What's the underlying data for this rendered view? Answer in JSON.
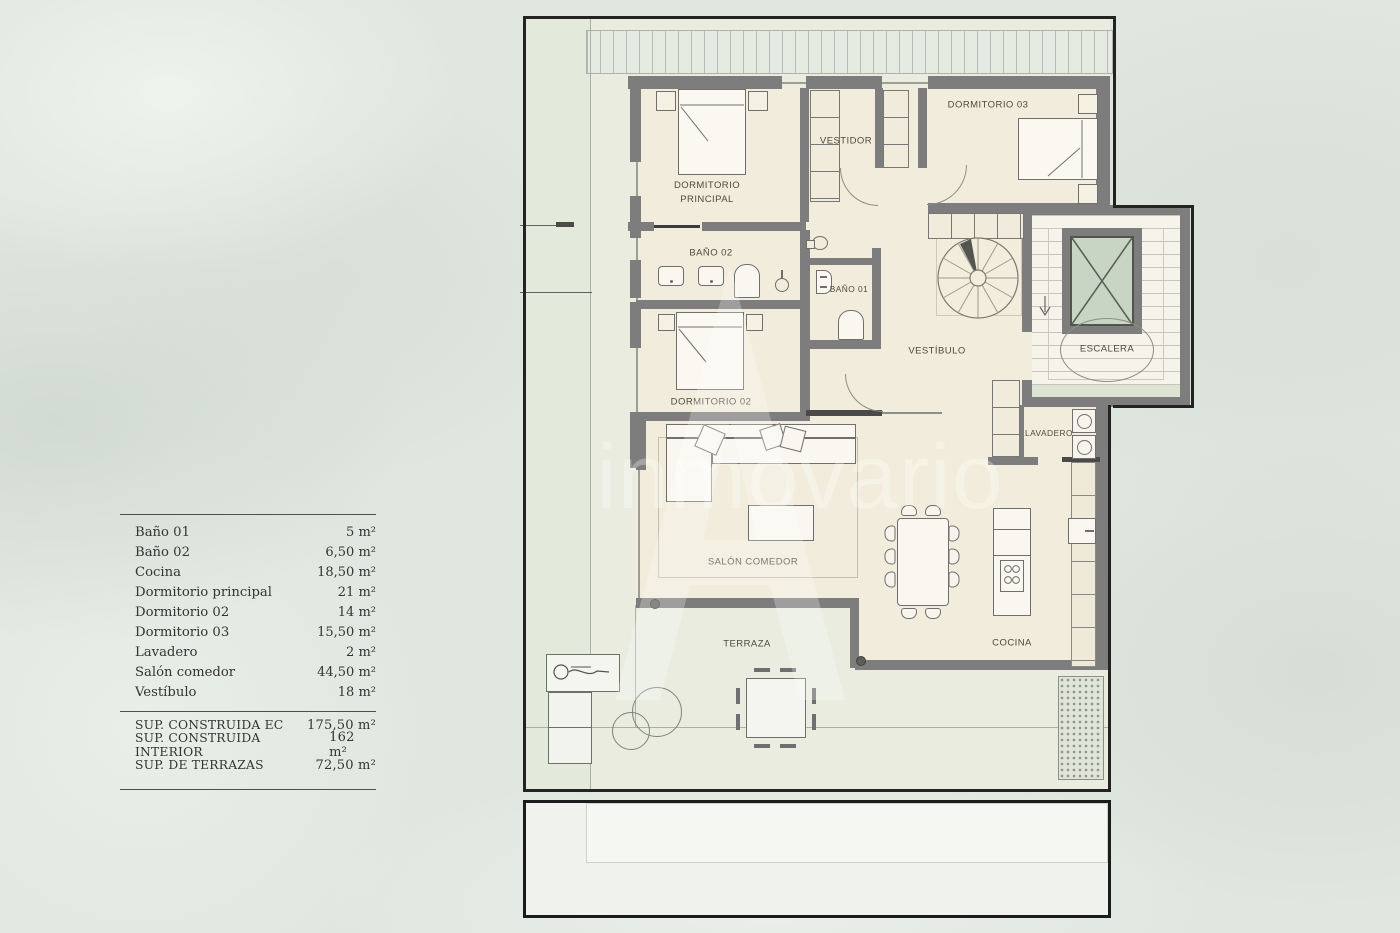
{
  "legend": {
    "rows": [
      {
        "label": "Baño 01",
        "value": "5 m²"
      },
      {
        "label": "Baño 02",
        "value": "6,50 m²"
      },
      {
        "label": "Cocina",
        "value": "18,50 m²"
      },
      {
        "label": "Dormitorio principal",
        "value": "21 m²"
      },
      {
        "label": "Dormitorio 02",
        "value": "14 m²"
      },
      {
        "label": "Dormitorio 03",
        "value": "15,50 m²"
      },
      {
        "label": "Lavadero",
        "value": "2 m²"
      },
      {
        "label": "Salón comedor",
        "value": "44,50 m²"
      },
      {
        "label": "Vestíbulo",
        "value": "18 m²"
      }
    ],
    "totals": [
      {
        "label": "SUP. CONSTRUIDA EC",
        "value": "175,50 m²"
      },
      {
        "label": "SUP. CONSTRUIDA INTERIOR",
        "value": "162 m²"
      },
      {
        "label": "SUP. DE TERRAZAS",
        "value": "72,50 m²"
      }
    ]
  },
  "plan": {
    "rooms": {
      "dormitorio_principal": {
        "line1": "DORMITORIO",
        "line2": "PRINCIPAL"
      },
      "vestidor": {
        "label": "VESTIDOR"
      },
      "dormitorio_03": {
        "label": "DORMITORIO 03"
      },
      "bano_02": {
        "label": "BAÑO 02"
      },
      "bano_01": {
        "label": "BAÑO 01"
      },
      "vestibulo": {
        "label": "VESTÍBULO"
      },
      "escalera": {
        "label": "ESCALERA"
      },
      "dormitorio_02": {
        "label": "DORMITORIO 02"
      },
      "lavadero": {
        "label": "LAVADERO"
      },
      "salon_comedor": {
        "label": "SALÓN COMEDOR"
      },
      "cocina": {
        "label": "COCINA"
      },
      "terraza": {
        "label": "TERRAZA"
      }
    }
  },
  "watermark": {
    "text": "inmovario"
  },
  "colors": {
    "background": "#e0e6e0",
    "floor": "#f1ecdb",
    "terrace": "#e9ecdf",
    "wall": "#7d7d7d",
    "outline": "#23231f",
    "elevator_glass": "#c9d5c4",
    "label_text": "#4f4a40"
  }
}
